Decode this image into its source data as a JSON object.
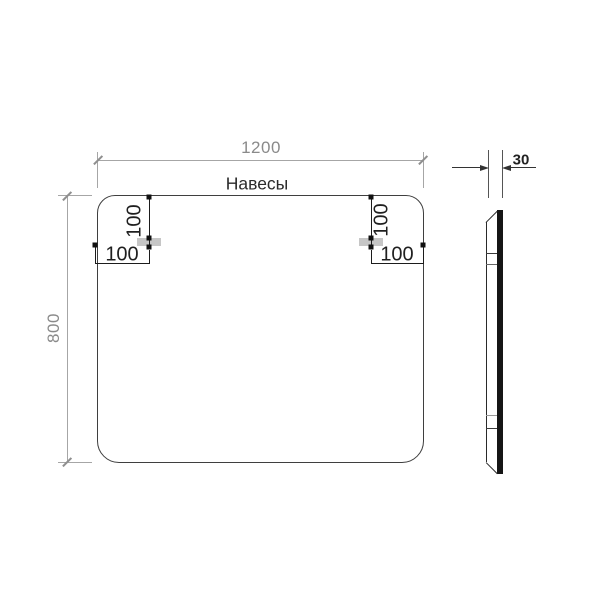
{
  "drawing_title": "Mirror dimension drawing",
  "front_view": {
    "shape": "rounded-rectangle",
    "width_mm": "1200",
    "height_mm": "800",
    "hangers_label": "Навесы",
    "hanger_offset_from_top_mm": "100",
    "hanger_offset_from_side_mm": "100",
    "hanger_count": 2
  },
  "side_view": {
    "depth_mm": "30"
  },
  "colors": {
    "background": "#ffffff",
    "outline": "#3f3f3f",
    "primary_dim": "#1f1f1f",
    "secondary_dim": "#8a8a8a",
    "bracket_fill": "#c6c6c6",
    "profile_bar": "#151515"
  }
}
